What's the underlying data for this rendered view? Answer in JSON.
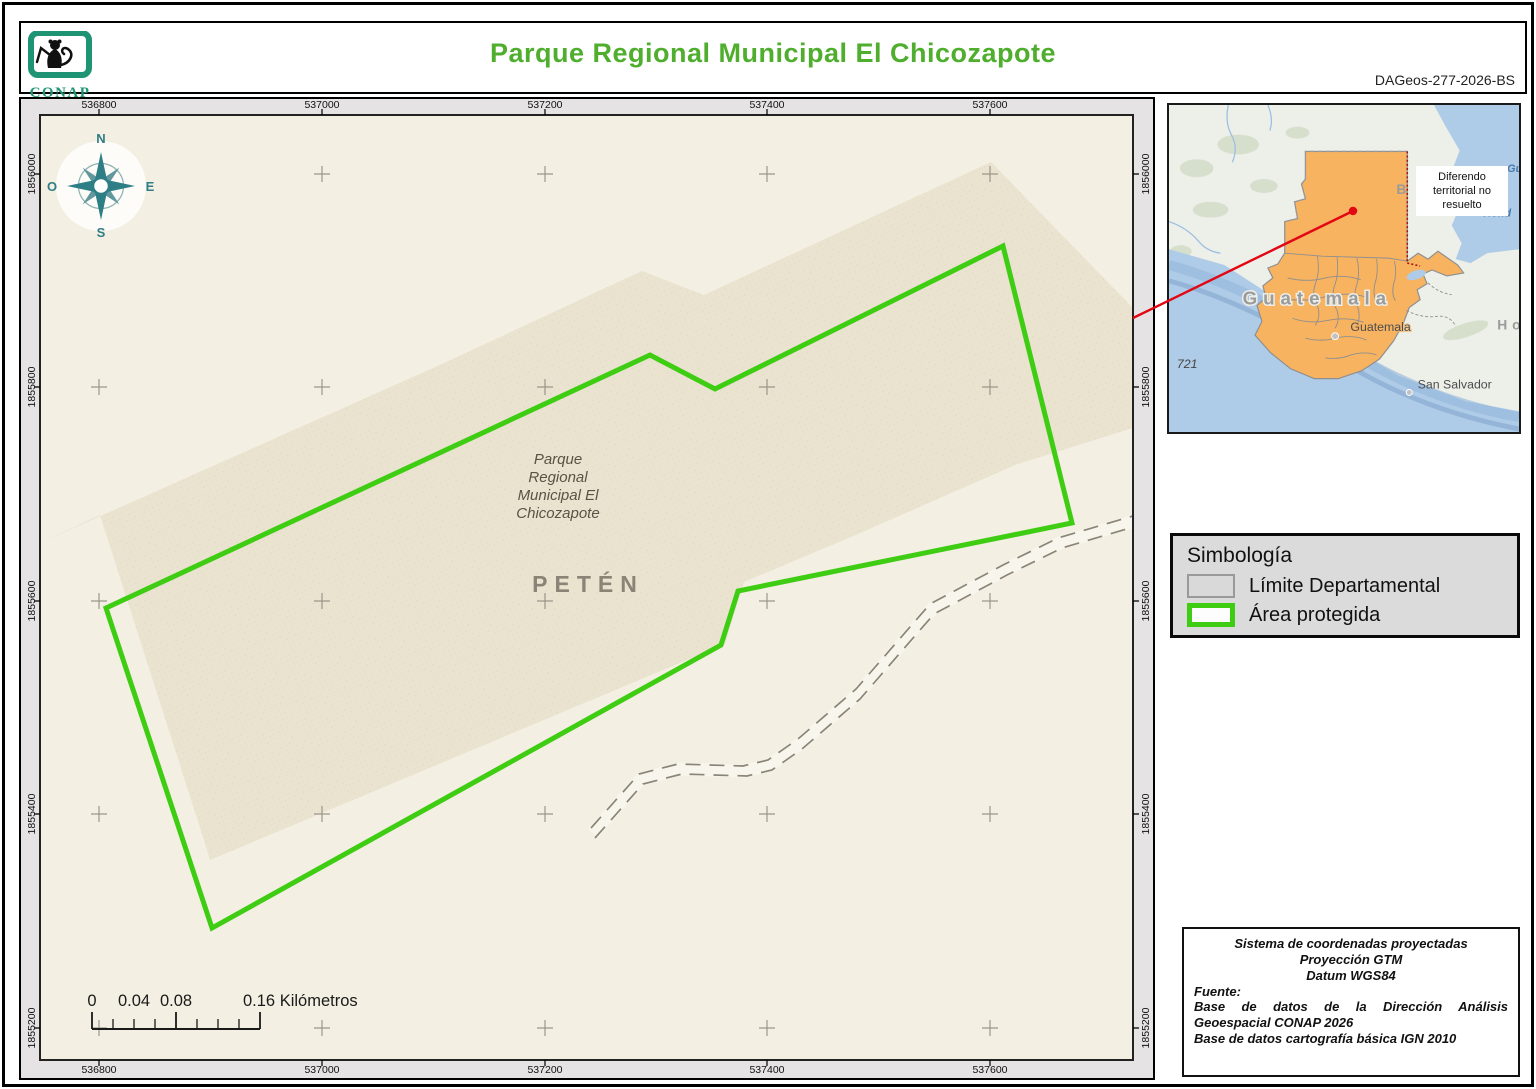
{
  "header": {
    "logo_text": "CONAP",
    "title": "Parque Regional Municipal El Chicozapote",
    "doc_code": "DAGeos-277-2026-BS"
  },
  "map": {
    "x_ticks": [
      "536800",
      "537000",
      "537200",
      "537400",
      "537600"
    ],
    "y_ticks": [
      "1856000",
      "1855800",
      "1855600",
      "1855400",
      "1855200"
    ],
    "compass": {
      "n": "N",
      "e": "E",
      "s": "S",
      "o": "O"
    },
    "park_label_lines": [
      "Parque",
      "Regional",
      "Municipal El",
      "Chicozapote"
    ],
    "region_label": "PETÉN",
    "scale": {
      "t0": "0",
      "t1": "0.04",
      "t2": "0.08",
      "t3": "0.16 Kilómetros"
    }
  },
  "inset": {
    "country_label": "Guatemala",
    "city_label": "Guatemala",
    "city2_label": "San Salvador",
    "honduras_fragment": "Ho",
    "sea_fragment_1": "Gu",
    "sea_fragment_2": "Hond",
    "road_number": "721",
    "belize_fragment": "B",
    "note_text": "Diferendo territorial no resuelto"
  },
  "legend": {
    "title": "Simbología",
    "items": [
      {
        "label": "Límite Departamental"
      },
      {
        "label": "Área protegida"
      }
    ]
  },
  "metadata": {
    "line1": "Sistema de coordenadas proyectadas",
    "line2": "Proyección GTM",
    "line3": "Datum WGS84",
    "line4": "Fuente:",
    "line5": "Base de datos de la Dirección Análisis Geoespacial CONAP 2026",
    "line6": "Base de datos cartografía básica IGN 2010"
  },
  "colors": {
    "title_green": "#4fae2d",
    "park_green": "#3ecd12",
    "compass_teal": "#2e7e85",
    "guatemala_orange": "#f7b360",
    "ocean_blue": "#aecbe7",
    "leader_red": "#e30613"
  }
}
